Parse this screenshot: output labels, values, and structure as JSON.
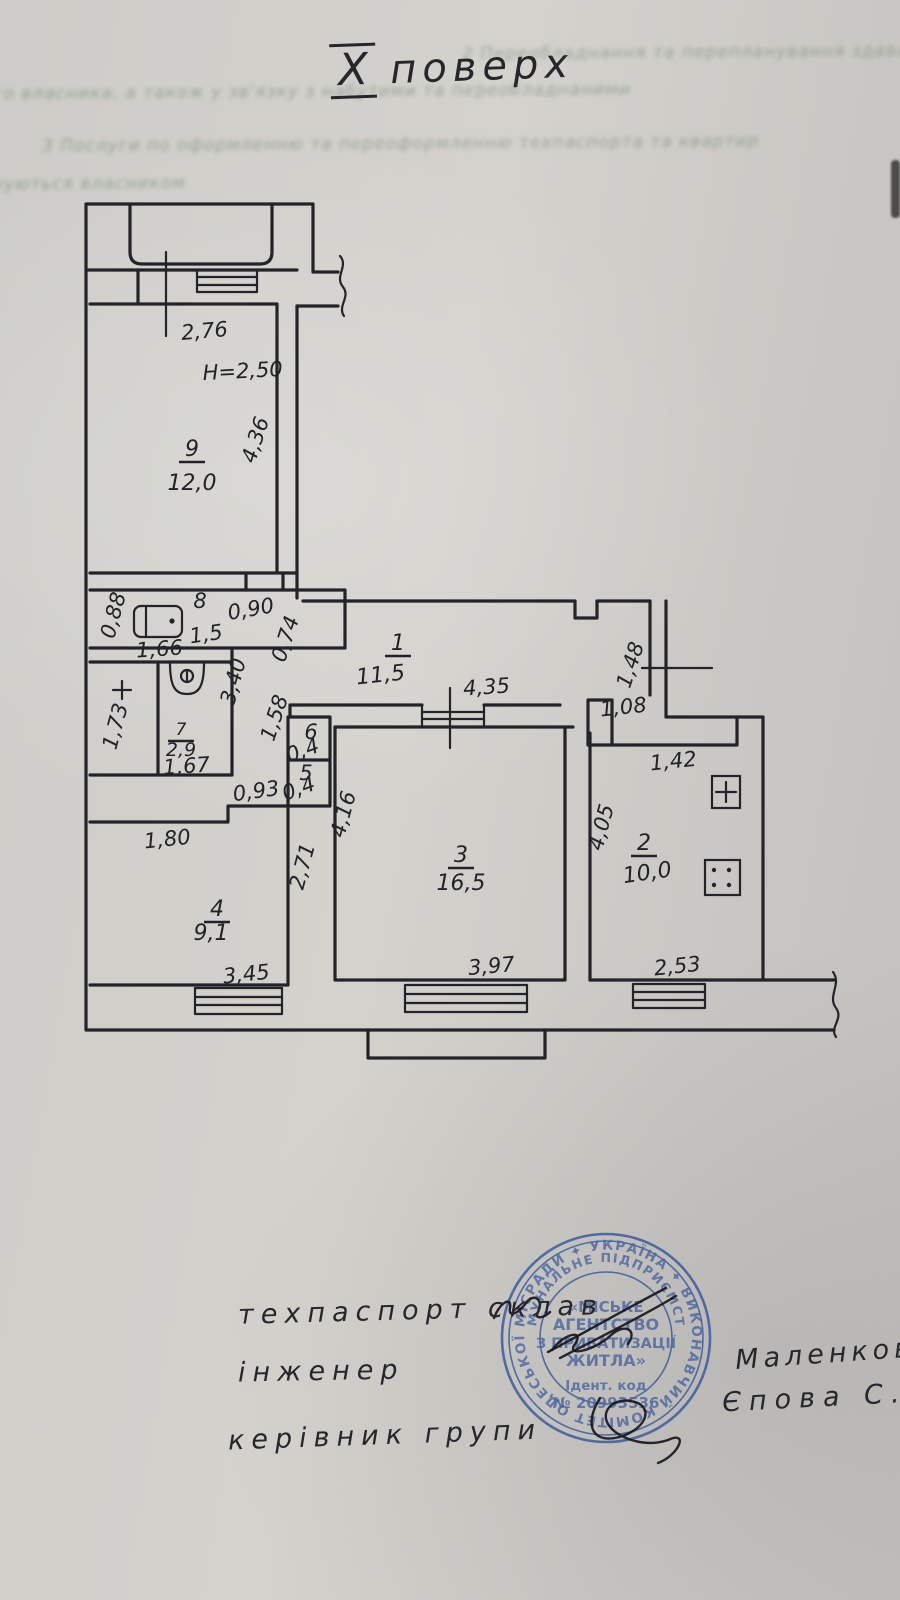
{
  "page": {
    "floor_numeral": "X",
    "floor_word": "поверх"
  },
  "bleed_lines": [
    "2 Переобладнання та перепланування здаватиму переобладнань",
    "ного власника, а також у зв'язку з набутими та переобладнаними",
    "3 Послуги по оформленню та переоформленню техпаспорта та квартир",
    "нуються власником"
  ],
  "plan": {
    "dim_labels": [
      {
        "t": "2,76",
        "x": 205,
        "y": 338,
        "r": -5
      },
      {
        "t": "H=2,50",
        "x": 243,
        "y": 378,
        "r": -3
      },
      {
        "t": "4,36",
        "x": 262,
        "y": 442,
        "r": -72
      },
      {
        "t": "0,88",
        "x": 120,
        "y": 617,
        "r": -75
      },
      {
        "t": "1,66",
        "x": 160,
        "y": 656,
        "r": -4
      },
      {
        "t": "8",
        "x": 200,
        "y": 608,
        "r": 0,
        "fs": 18
      },
      {
        "t": "1,5",
        "x": 207,
        "y": 641,
        "r": -8,
        "fs": 19
      },
      {
        "t": "0,90",
        "x": 252,
        "y": 616,
        "r": -10
      },
      {
        "t": "0,74",
        "x": 292,
        "y": 641,
        "r": -72,
        "fs": 18
      },
      {
        "t": "3,40",
        "x": 240,
        "y": 683,
        "r": -75
      },
      {
        "t": "1,73",
        "x": 122,
        "y": 728,
        "r": -75
      },
      {
        "t": "1,67",
        "x": 187,
        "y": 773,
        "r": -4,
        "fs": 18
      },
      {
        "t": "1,58",
        "x": 281,
        "y": 720,
        "r": -72,
        "fs": 17
      },
      {
        "t": "6",
        "x": 311,
        "y": 739,
        "r": 0,
        "fs": 15
      },
      {
        "t": "0,4",
        "x": 305,
        "y": 757,
        "r": -20,
        "fs": 15
      },
      {
        "t": "5",
        "x": 306,
        "y": 780,
        "r": 0,
        "fs": 15
      },
      {
        "t": "0,4",
        "x": 301,
        "y": 795,
        "r": -20,
        "fs": 15
      },
      {
        "t": "0,93",
        "x": 257,
        "y": 798,
        "r": -8
      },
      {
        "t": "1,80",
        "x": 168,
        "y": 846,
        "r": -6
      },
      {
        "t": "3,45",
        "x": 247,
        "y": 981,
        "r": -6
      },
      {
        "t": "2,71",
        "x": 309,
        "y": 868,
        "r": -75
      },
      {
        "t": "4,16",
        "x": 350,
        "y": 816,
        "r": -75
      },
      {
        "t": "4,35",
        "x": 487,
        "y": 694,
        "r": -4
      },
      {
        "t": "3,97",
        "x": 492,
        "y": 973,
        "r": -5
      },
      {
        "t": "1,48",
        "x": 637,
        "y": 667,
        "r": -72
      },
      {
        "t": "1,08",
        "x": 624,
        "y": 714,
        "r": -6
      },
      {
        "t": "1,42",
        "x": 674,
        "y": 768,
        "r": -6
      },
      {
        "t": "4,05",
        "x": 608,
        "y": 829,
        "r": -75
      },
      {
        "t": "2,53",
        "x": 678,
        "y": 973,
        "r": -6
      }
    ],
    "room_labels": [
      {
        "num": "1",
        "area": "11,5",
        "x": 398,
        "y": 650,
        "adx": -20,
        "ady": 30,
        "ar": -6
      },
      {
        "num": "2",
        "area": "10,0",
        "x": 644,
        "y": 850,
        "ady": 30,
        "ar": -8
      },
      {
        "num": "3",
        "area": "16,5",
        "x": 461,
        "y": 862,
        "ady": 28
      },
      {
        "num": "4",
        "area": "9,1",
        "x": 217,
        "y": 916,
        "ady": 24,
        "adx": -6
      },
      {
        "num": "7",
        "area": "2,9",
        "x": 181,
        "y": 735,
        "ady": 21,
        "fs": 17,
        "afs": 19
      },
      {
        "num": "9",
        "area": "12,0",
        "x": 192,
        "y": 456,
        "ady": 34
      }
    ]
  },
  "footer": {
    "line1": "техпаспорт склав",
    "line2": "інженер",
    "line3": "керівник групи",
    "name1": "Маленкова",
    "name2": "Єпова С.А"
  },
  "stamp": {
    "ring_outer": "РАДИ ✦ УКРАЇНА ✦ ВИКОНАВЧИЙ КОМІТЕТ ОДЕСЬКОЇ МІСЬКОЇ ",
    "ring_inner": "КОМУНАЛЬНЕ ПІДПРИЄМСТВО",
    "center_lines": [
      "«МІСЬКЕ",
      "АГЕНТСТВО",
      "З ПРИВАТИЗАЦІЇ",
      "ЖИТЛА»",
      "Ідент. код",
      "№ 20993536"
    ],
    "color": "#3f5fa0",
    "ink_color": "#232329"
  }
}
